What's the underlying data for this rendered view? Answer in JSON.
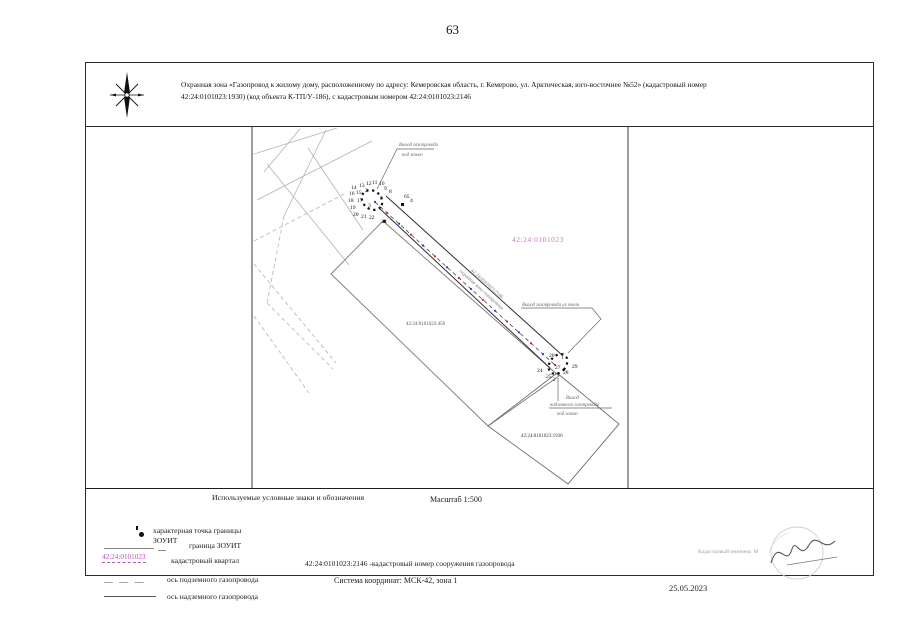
{
  "page": {
    "number": "63"
  },
  "header": {
    "line1": "Охранная зона «Газопровод к жилому дому, расположенному по адресу: Кемеровская область, г. Кемерово, ул. Арктическая, юго-восточнее №52» (кадастровый номер",
    "line2": "42:24:0101023:1930) (код объекта К-ТП/У-186), с кадастровым номером 42:24:0101023:2146"
  },
  "map": {
    "quarter_label": "42:24:0101023",
    "parcel_label_450": "42:24:0101023:450",
    "parcel_label_1930": "42:24:0101023:1930",
    "pipeline_label_line1": "42:24:0101023:2146",
    "pipeline_label_line2": "охранная зона газопровода",
    "callout_top_line1": "Выход газопровода",
    "callout_top_line2": "под землю",
    "callout_right": "Выход газопровода из земли",
    "callout_bottom_line1": "Выход",
    "callout_bottom_line2": "надземного газопровода",
    "callout_bottom_line3": "под землю",
    "points_upper": [
      {
        "n": "14",
        "x": 350,
        "y": 188
      },
      {
        "n": "13",
        "x": 358,
        "y": 186
      },
      {
        "n": "12",
        "x": 365,
        "y": 184
      },
      {
        "n": "11",
        "x": 371,
        "y": 183
      },
      {
        "n": "10",
        "x": 378,
        "y": 184
      },
      {
        "n": "9",
        "x": 383,
        "y": 189
      },
      {
        "n": "8",
        "x": 388,
        "y": 192
      },
      {
        "n": "16",
        "x": 348,
        "y": 194
      },
      {
        "n": "15",
        "x": 355,
        "y": 193
      },
      {
        "n": "2",
        "x": 364,
        "y": 191
      },
      {
        "n": "7",
        "x": 379,
        "y": 199
      },
      {
        "n": "18",
        "x": 347,
        "y": 201
      },
      {
        "n": "17",
        "x": 356,
        "y": 201
      },
      {
        "n": "19",
        "x": 349,
        "y": 208
      },
      {
        "n": "3",
        "x": 367,
        "y": 206
      },
      {
        "n": "20",
        "x": 352,
        "y": 215
      },
      {
        "n": "21",
        "x": 360,
        "y": 217
      },
      {
        "n": "22",
        "x": 368,
        "y": 218
      },
      {
        "n": "65",
        "x": 403,
        "y": 197
      },
      {
        "n": "4",
        "x": 409,
        "y": 201
      },
      {
        "n": "23",
        "x": 380,
        "y": 222
      }
    ],
    "points_lower": [
      {
        "n": "26",
        "x": 548,
        "y": 356
      },
      {
        "n": "1",
        "x": 560,
        "y": 358
      },
      {
        "n": "27",
        "x": 554,
        "y": 368
      },
      {
        "n": "29",
        "x": 571,
        "y": 367
      },
      {
        "n": "28",
        "x": 562,
        "y": 373
      },
      {
        "n": "24",
        "x": 536,
        "y": 371
      },
      {
        "n": "25",
        "x": 545,
        "y": 377
      },
      {
        "n": "2",
        "x": 552,
        "y": 380
      }
    ]
  },
  "legend": {
    "title": "Используемые условные  знаки и обозначения",
    "scale": "Масштаб 1:500",
    "item1_line1": "характерная точка границы",
    "item1_line2": "ЗОУИТ",
    "item2": "граница ЗОУИТ",
    "item3_symbol": "42:24:0101023",
    "item3": "кадастровый квартал",
    "item4": "ось подземного газопровода",
    "item5": "ось надземного газопровода",
    "cad_number": "42:24:0101023:2146",
    "cad_number_desc": "-кадастровый  номер сооружения газопровода",
    "coord_system": "Система координат: МСК-42, зона 1"
  },
  "footer": {
    "engineer": "Кадастровый инженер: М",
    "date": "25.05.2023"
  },
  "colors": {
    "axis_red": "#c62828",
    "axis_blue": "#283bc6",
    "quarter_magenta": "#b44fb4"
  }
}
